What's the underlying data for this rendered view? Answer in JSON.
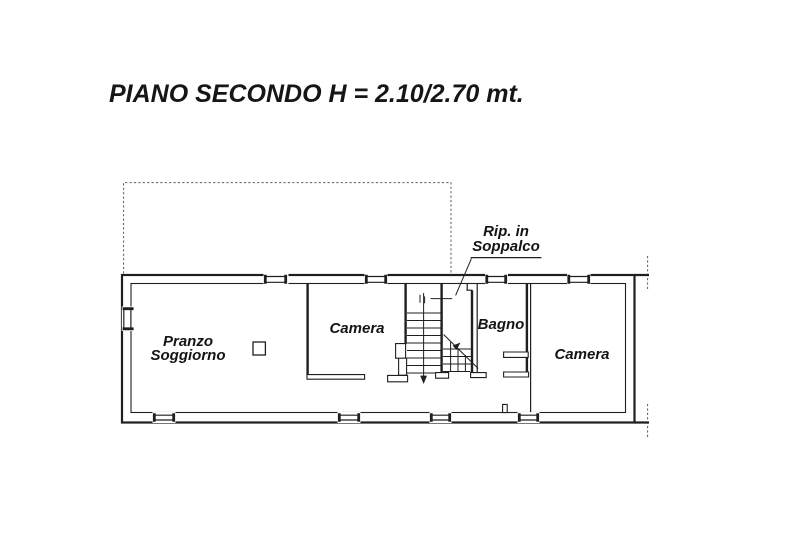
{
  "title": "PIANO SECONDO H = 2.10/2.70 mt.",
  "plan": {
    "rooms": {
      "pranzo_soggiorno": {
        "line1": "Pranzo",
        "line2": "Soggiorno"
      },
      "camera_left": {
        "label": "Camera"
      },
      "bagno": {
        "label": "Bagno"
      },
      "camera_right": {
        "label": "Camera"
      }
    },
    "annotation": {
      "line1": "Rip. in",
      "line2": "Soppalco"
    }
  },
  "colors": {
    "background": "#ffffff",
    "line": "#1f1f1f",
    "dashed_line": "#5a5a5a",
    "label_text": "#141414"
  }
}
